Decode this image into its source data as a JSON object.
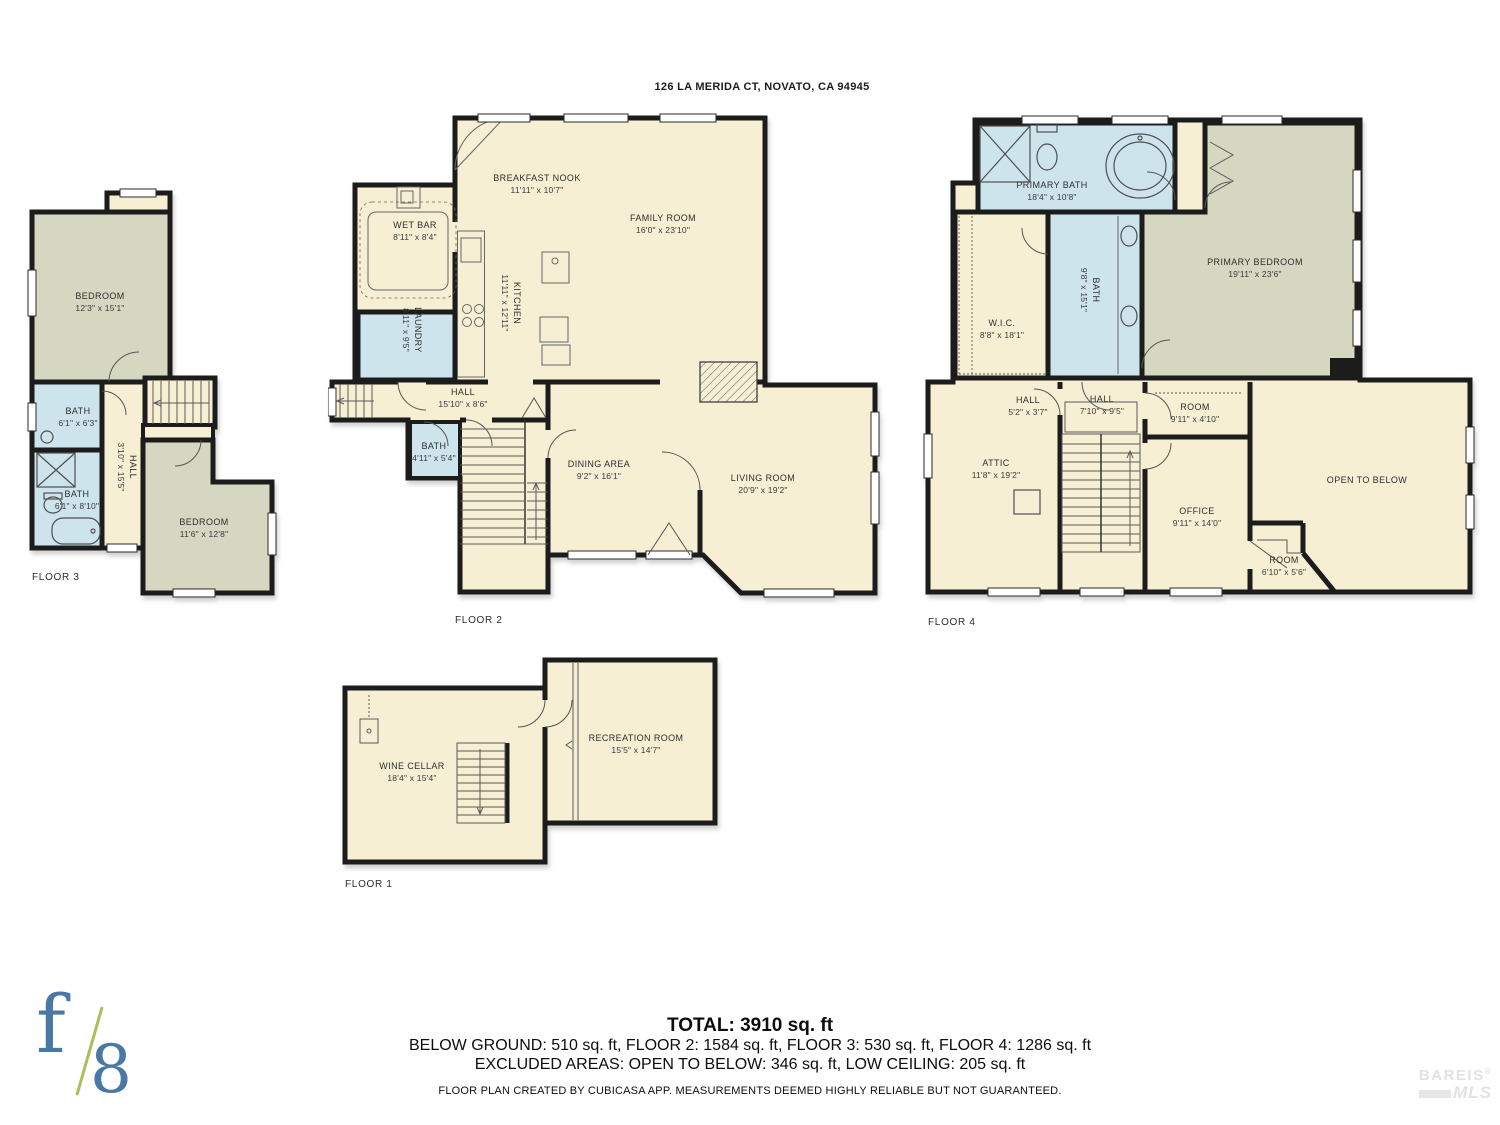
{
  "address": "126 LA MERIDA CT, NOVATO, CA 94945",
  "colors": {
    "room_default": "#f6efd3",
    "room_bedroom": "#d5d7c0",
    "room_wet": "#cde4ec",
    "wall": "#1c1c1c"
  },
  "floors": [
    {
      "label": "FLOOR 3",
      "rooms": [
        {
          "name": "BEDROOM",
          "dims": "12'3\" x 15'1\""
        },
        {
          "name": "BATH",
          "dims": "6'1\" x 6'3\""
        },
        {
          "name": "BATH",
          "dims": "6'1\" x 8'10\""
        },
        {
          "name": "HALL",
          "dims": "3'10\" x 15'5\""
        },
        {
          "name": "BEDROOM",
          "dims": "11'6\" x 12'8\""
        }
      ]
    },
    {
      "label": "FLOOR 2",
      "rooms": [
        {
          "name": "BREAKFAST NOOK",
          "dims": "11'11\" x 10'7\""
        },
        {
          "name": "WET BAR",
          "dims": "8'11\" x 8'4\""
        },
        {
          "name": "FAMILY ROOM",
          "dims": "16'0\" x 23'10\""
        },
        {
          "name": "LAUNDRY",
          "dims": "8'11\" x 9'5\""
        },
        {
          "name": "KITCHEN",
          "dims": "11'11\" x 12'11\""
        },
        {
          "name": "HALL",
          "dims": "15'10\" x 8'6\""
        },
        {
          "name": "BATH",
          "dims": "4'11\" x 5'4\""
        },
        {
          "name": "DINING AREA",
          "dims": "9'2\" x 16'1\""
        },
        {
          "name": "LIVING ROOM",
          "dims": "20'9\" x 19'2\""
        }
      ]
    },
    {
      "label": "FLOOR 4",
      "rooms": [
        {
          "name": "PRIMARY BATH",
          "dims": "18'4\" x 10'8\""
        },
        {
          "name": "W.I.C.",
          "dims": "8'8\" x 18'1\""
        },
        {
          "name": "BATH",
          "dims": "9'8\" x 15'1\""
        },
        {
          "name": "PRIMARY BEDROOM",
          "dims": "19'11\" x 23'6\""
        },
        {
          "name": "HALL",
          "dims": "5'2\" x 3'7\""
        },
        {
          "name": "HALL",
          "dims": "7'10\" x 9'5\""
        },
        {
          "name": "ROOM",
          "dims": "9'11\" x 4'10\""
        },
        {
          "name": "ATTIC",
          "dims": "11'8\" x 19'2\""
        },
        {
          "name": "OFFICE",
          "dims": "9'11\" x 14'0\""
        },
        {
          "name": "OPEN TO BELOW",
          "dims": ""
        },
        {
          "name": "ROOM",
          "dims": "6'10\" x 5'6\""
        }
      ]
    },
    {
      "label": "FLOOR 1",
      "rooms": [
        {
          "name": "WINE CELLAR",
          "dims": "18'4\" x 15'4\""
        },
        {
          "name": "RECREATION ROOM",
          "dims": "15'5\" x 14'7\""
        }
      ]
    }
  ],
  "summary": {
    "total": "TOTAL: 3910 sq. ft",
    "by_floor": "BELOW GROUND: 510 sq. ft, FLOOR 2: 1584 sq. ft, FLOOR 3: 530 sq. ft, FLOOR 4: 1286 sq. ft",
    "excluded": "EXCLUDED AREAS: OPEN TO BELOW: 346 sq. ft, LOW CEILING: 205 sq. ft",
    "disclaimer": "FLOOR PLAN CREATED BY CUBICASA APP. MEASUREMENTS DEEMED HIGHLY RELIABLE BUT NOT GUARANTEED."
  },
  "logos": {
    "f8": {
      "f": "f",
      "eight": "8"
    },
    "bareis": {
      "name": "BAREIS",
      "reg": "®",
      "mls": "MLS"
    }
  }
}
